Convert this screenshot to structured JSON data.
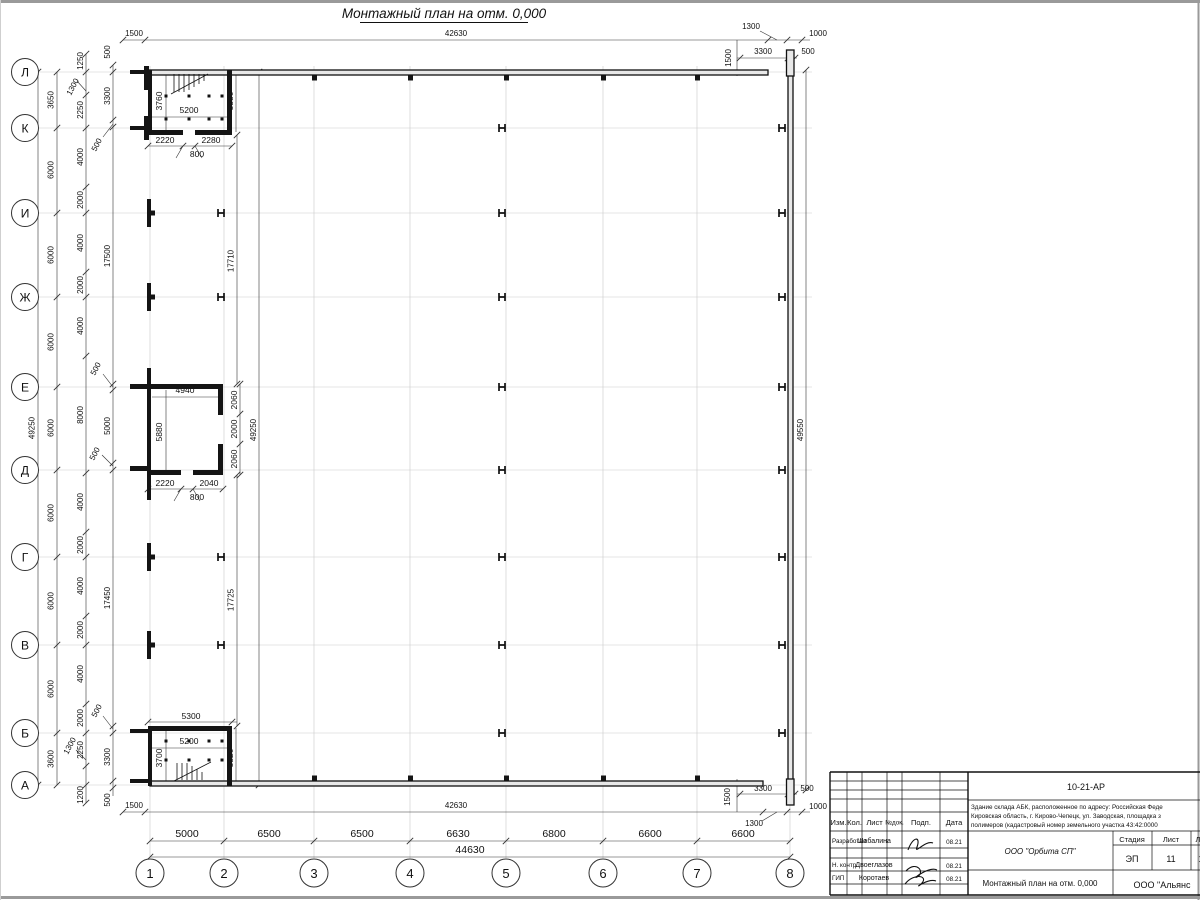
{
  "sheet_title": "Монтажный план на отм. 0,000",
  "axes": {
    "rows": [
      "Л",
      "К",
      "И",
      "Ж",
      "Е",
      "Д",
      "Г",
      "В",
      "Б",
      "А"
    ],
    "cols": [
      "1",
      "2",
      "3",
      "4",
      "5",
      "6",
      "7",
      "8"
    ]
  },
  "dims": {
    "top": [
      "1500",
      "42630",
      "1300",
      "1000"
    ],
    "top_right": [
      "1500",
      "3300",
      "500"
    ],
    "left_total": "49250",
    "left_axis": [
      "3650",
      "6000",
      "6000",
      "6000",
      "6000",
      "6000",
      "6000",
      "6000",
      "3600"
    ],
    "left_fine": [
      "1250",
      "2250",
      "4000",
      "2000",
      "4000",
      "2000",
      "4000",
      "8000",
      "4000",
      "2000",
      "4000",
      "2000",
      "4000",
      "2000",
      "2250",
      "1200"
    ],
    "left_fine_diag": [
      "1300",
      "1300"
    ],
    "left_inner": [
      "500",
      "3300",
      "17500",
      "5000",
      "17450",
      "3300",
      "500"
    ],
    "left_inner_diag": [
      "500",
      "500",
      "500",
      "500"
    ],
    "right_total": "49550",
    "inner_vertical": [
      "17710",
      "49250",
      "17725"
    ],
    "bottom": [
      "1500",
      "42630"
    ],
    "bottom_right": [
      "1500",
      "3300",
      "500",
      "1000",
      "1300"
    ],
    "bottom_chain": [
      "5000",
      "6500",
      "6500",
      "6630",
      "6800",
      "6600",
      "6600"
    ],
    "bottom_total": "44630",
    "room_top": [
      "3760",
      "5200",
      "3880",
      "2220",
      "2280",
      "800"
    ],
    "room_mid": [
      "4940",
      "5880",
      "2060",
      "2000",
      "2060",
      "2220",
      "2040",
      "800"
    ],
    "room_bot": [
      "5300",
      "5200",
      "3700",
      "3820"
    ]
  },
  "title_block": {
    "doc_number": "10-21-АР",
    "object_lines": [
      "Здание склада АБК, расположенное по адресу: Российская Феде",
      "Кировская область, г. Кирово-Чепецк, ул. Заводская, площадка з",
      "полимеров (кадастровый номер земельного участка 43:42:0000"
    ],
    "cols": [
      "Изм.",
      "Кол.",
      "Лист",
      "№док.",
      "Подп.",
      "Дата"
    ],
    "people": [
      {
        "role": "Разработал",
        "name": "Шабалина",
        "date": "08.21"
      },
      {
        "role": "Н. контр.",
        "name": "Двоеглазов",
        "date": "08.21"
      },
      {
        "role": "ГИП",
        "name": "Коротаев",
        "date": "08.21"
      }
    ],
    "org": "ООО \"Орбита СП\"",
    "stage_h": "Стадия",
    "sheet_h": "Лист",
    "sheets_h": "Ли",
    "stage": "ЭП",
    "sheet_no": "11",
    "sheets_no": "1",
    "drawing_title": "Монтажный план на отм. 0,000",
    "contractor": "ООО \"Альянс"
  }
}
